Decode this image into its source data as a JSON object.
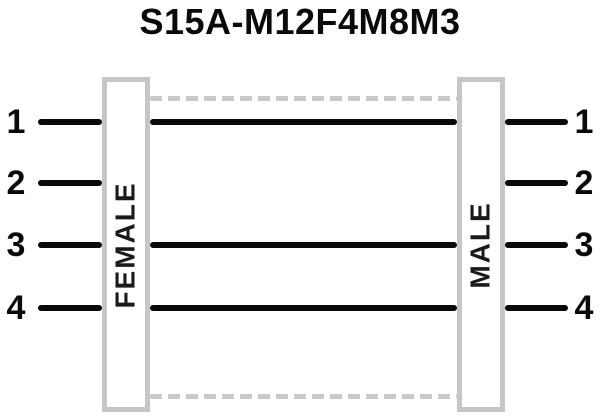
{
  "title": "S15A-M12F4M8M3",
  "connectors": {
    "left": {
      "label": "FEMALE",
      "side": "left"
    },
    "right": {
      "label": "MALE",
      "side": "right"
    }
  },
  "pins": {
    "left": [
      "1",
      "2",
      "3",
      "4"
    ],
    "right": [
      "1",
      "2",
      "3",
      "4"
    ]
  },
  "wiring": {
    "connections": [
      {
        "from_pin": "1",
        "to_pin": "1",
        "style": "solid-through"
      },
      {
        "from_pin": "3",
        "to_pin": "3",
        "style": "solid-through"
      },
      {
        "from_pin": "4",
        "to_pin": "4",
        "style": "solid-through"
      }
    ],
    "open_pins": [
      "2"
    ],
    "shield_lines": {
      "style": "dashed",
      "positions": [
        "top",
        "bottom"
      ]
    }
  },
  "colors": {
    "wire": "#0a0a0a",
    "connector_border": "#c6c6c6",
    "shield_dash": "#c9c9c9",
    "background": "#ffffff",
    "text": "#0a0a0a"
  }
}
